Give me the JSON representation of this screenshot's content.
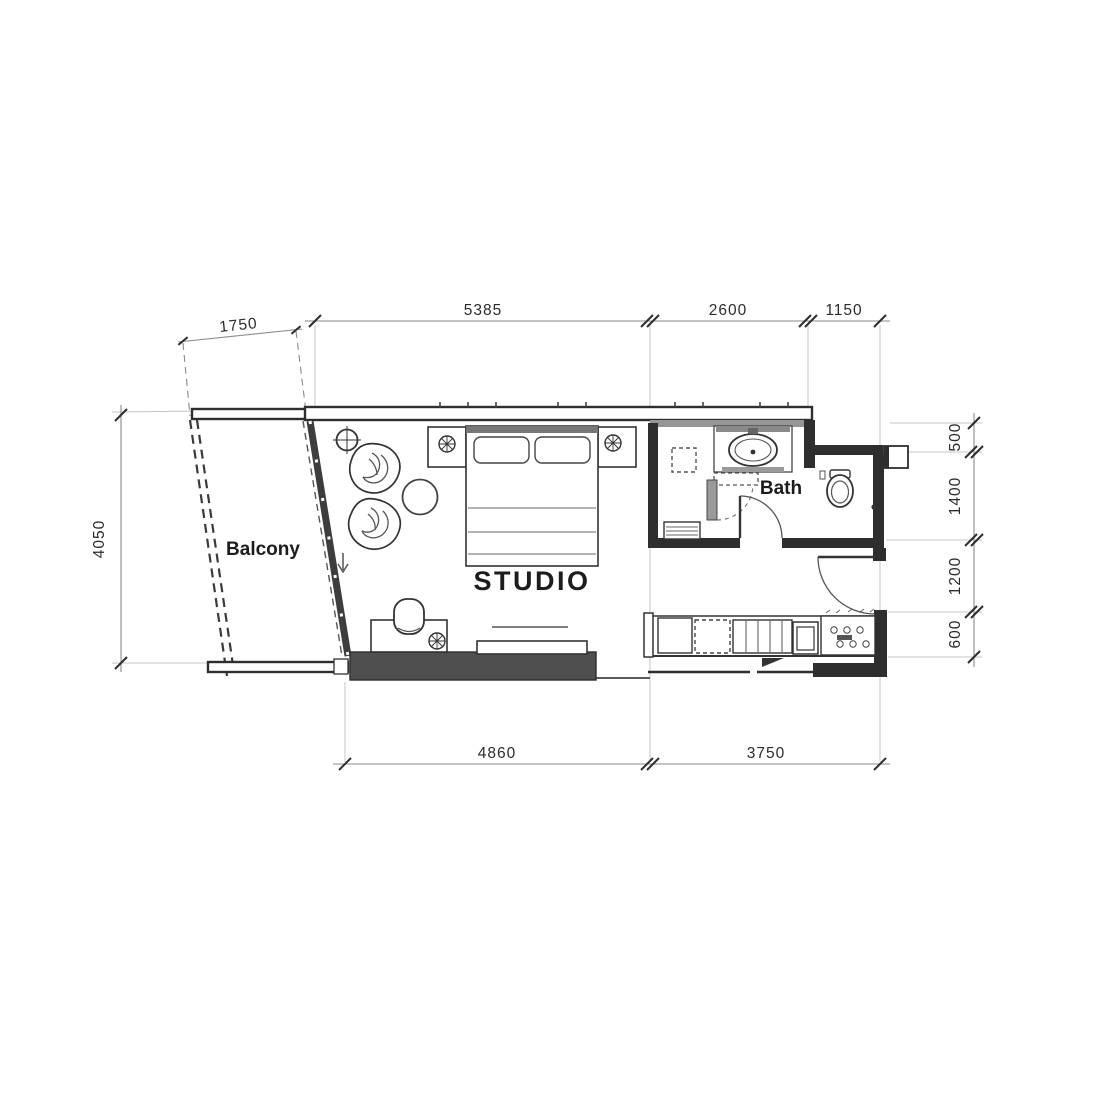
{
  "canvas": {
    "width": 1100,
    "height": 1100,
    "background": "#ffffff"
  },
  "plan": {
    "type": "architectural-floor-plan",
    "rooms": [
      {
        "id": "balcony",
        "label": "Balcony"
      },
      {
        "id": "studio",
        "label": "STUDIO"
      },
      {
        "id": "bath",
        "label": "Bath"
      }
    ],
    "dimensions": {
      "top": [
        {
          "value": "1750"
        },
        {
          "value": "5385"
        },
        {
          "value": "2600"
        },
        {
          "value": "1150"
        }
      ],
      "left": [
        {
          "value": "4050"
        }
      ],
      "right": [
        {
          "value": "500"
        },
        {
          "value": "1400"
        },
        {
          "value": "1200"
        },
        {
          "value": "600"
        }
      ],
      "bottom": [
        {
          "value": "4860"
        },
        {
          "value": "3750"
        }
      ]
    },
    "symbols": {
      "ceiling_light": "crosshair-circle",
      "plants": "flower-cross-circle",
      "door_swing": "quarter-arc",
      "sliding_door_arrow": "down-arrow"
    },
    "colors": {
      "wall": "#2e2e2e",
      "wall_gray_band": "#969696",
      "media_wall_fill": "#4f4f4f",
      "dim_line": "#8a8a8a",
      "extension_line": "#c4c4c4",
      "dim_text": "#2b2b2b",
      "room_text": "#1c1c1c",
      "paper": "#ffffff"
    }
  }
}
